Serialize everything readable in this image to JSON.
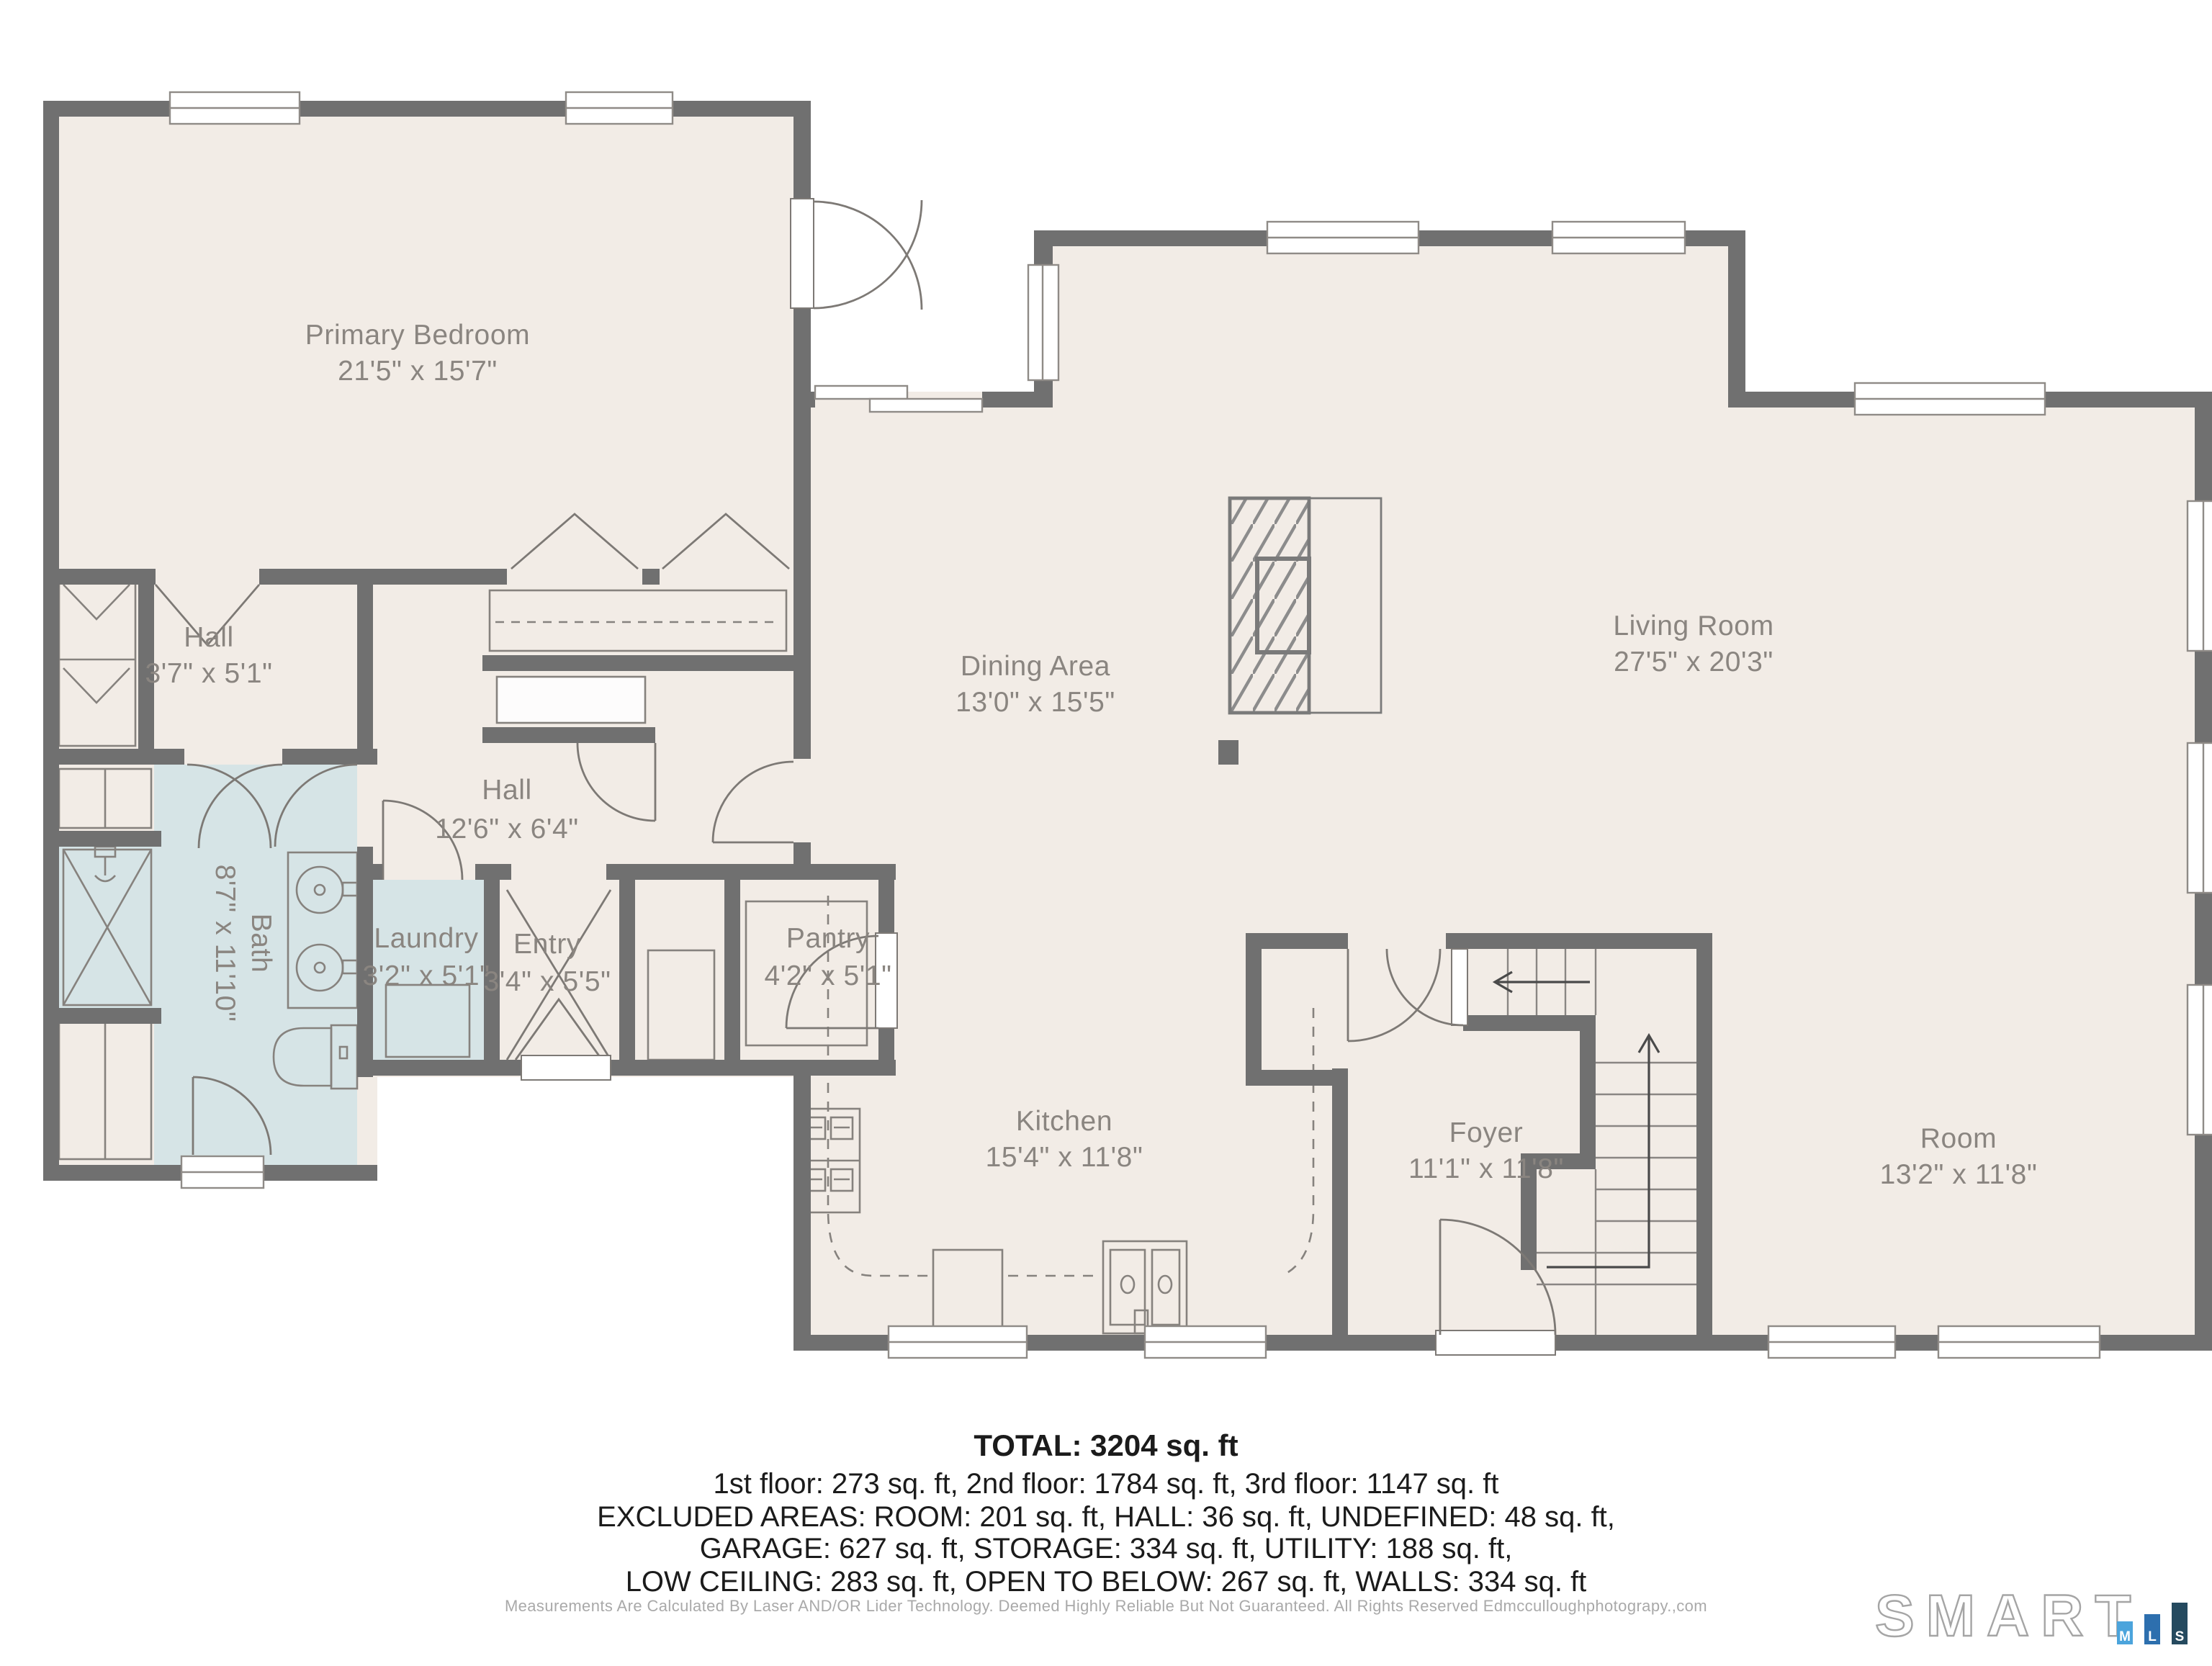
{
  "floorplan": {
    "rooms": [
      {
        "id": "primary-bedroom",
        "name": "Primary Bedroom",
        "dims": "21'5\" x 15'7\""
      },
      {
        "id": "hall-upper",
        "name": "Hall",
        "dims": "3'7\" x 5'1\""
      },
      {
        "id": "hall-main",
        "name": "Hall",
        "dims": "12'6\" x 6'4\""
      },
      {
        "id": "bath",
        "name": "Bath",
        "dims": "8'7\" x 11'10\""
      },
      {
        "id": "laundry",
        "name": "Laundry",
        "dims": "3'2\" x 5'1\""
      },
      {
        "id": "entry",
        "name": "Entry",
        "dims": "3'4\" x 5'5\""
      },
      {
        "id": "pantry",
        "name": "Pantry",
        "dims": "4'2\" x 5'1\""
      },
      {
        "id": "dining",
        "name": "Dining Area",
        "dims": "13'0\" x 15'5\""
      },
      {
        "id": "living",
        "name": "Living Room",
        "dims": "27'5\" x 20'3\""
      },
      {
        "id": "kitchen",
        "name": "Kitchen",
        "dims": "15'4\" x 11'8\""
      },
      {
        "id": "foyer",
        "name": "Foyer",
        "dims": "11'1\" x 11'8\""
      },
      {
        "id": "room",
        "name": "Room",
        "dims": "13'2\" x 11'8\""
      }
    ],
    "colors": {
      "wall": "#707070",
      "floor": "#f2ece6",
      "wet_room": "#d6e4e6",
      "label_text": "#8a8580"
    }
  },
  "summary": {
    "total": "TOTAL: 3204 sq. ft",
    "lines": [
      "1st floor: 273 sq. ft, 2nd floor: 1784 sq. ft, 3rd floor: 1147 sq. ft",
      "EXCLUDED AREAS: ROOM: 201 sq. ft, HALL: 36 sq. ft, UNDEFINED: 48 sq. ft,",
      "GARAGE: 627 sq. ft, STORAGE: 334 sq. ft, UTILITY: 188 sq. ft,",
      "LOW CEILING: 283 sq. ft, OPEN TO BELOW: 267 sq. ft, WALLS: 334 sq. ft"
    ]
  },
  "disclaimer": "Measurements Are Calculated By Laser AND/OR Lider Technology. Deemed Highly Reliable But Not Guaranteed. All Rights Reserved Edmcculloughphotograpy.,com",
  "logo": {
    "wordmark": "SMART",
    "bars": [
      {
        "letter": "M",
        "color": "#4ba4dc"
      },
      {
        "letter": "L",
        "color": "#2d6fae"
      },
      {
        "letter": "S",
        "color": "#254a5f"
      }
    ]
  }
}
